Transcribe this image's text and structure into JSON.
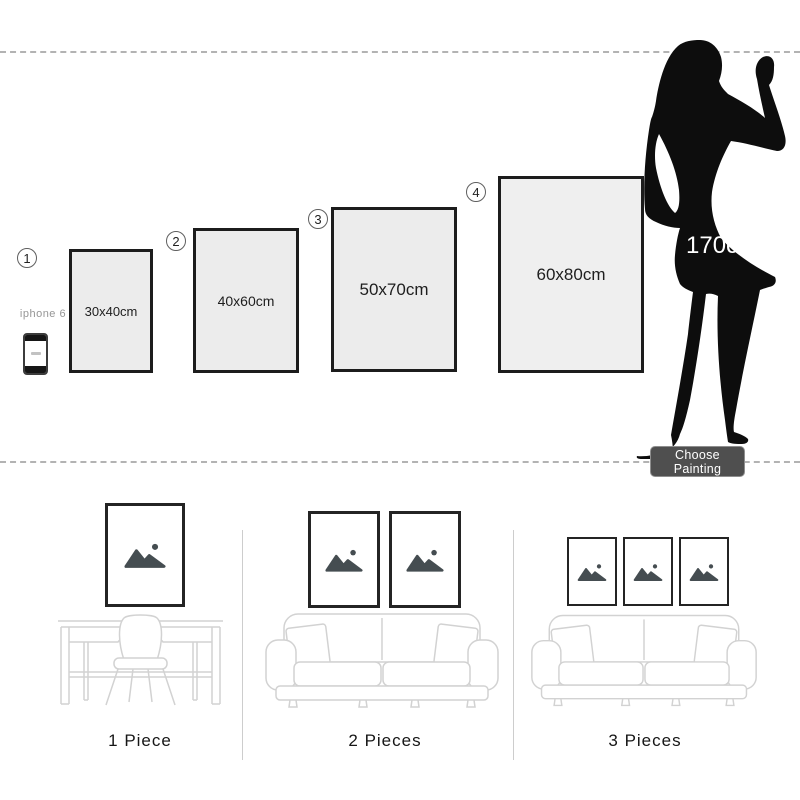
{
  "size_comparison": {
    "reference_person_height": "170cm",
    "reference_device": "iphone 6",
    "choose_button": "Choose Painting",
    "sizes": [
      {
        "index": "1",
        "dimensions": "30x40cm"
      },
      {
        "index": "2",
        "dimensions": "40x60cm"
      },
      {
        "index": "3",
        "dimensions": "50x70cm"
      },
      {
        "index": "4",
        "dimensions": "60x80cm"
      }
    ]
  },
  "arrangements": [
    {
      "label": "1 Piece"
    },
    {
      "label": "2 Pieces"
    },
    {
      "label": "3 Pieces"
    }
  ],
  "colors": {
    "frame_fill": "#ececec",
    "frame_border": "#1c1c1c",
    "silhouette": "#0d0d0d",
    "button_bg": "#4f4f4f",
    "button_text": "#ffffff",
    "dashed_line": "#b3b3b3",
    "furniture_line": "#d2d2d2",
    "placeholder_icon": "#454d51"
  }
}
